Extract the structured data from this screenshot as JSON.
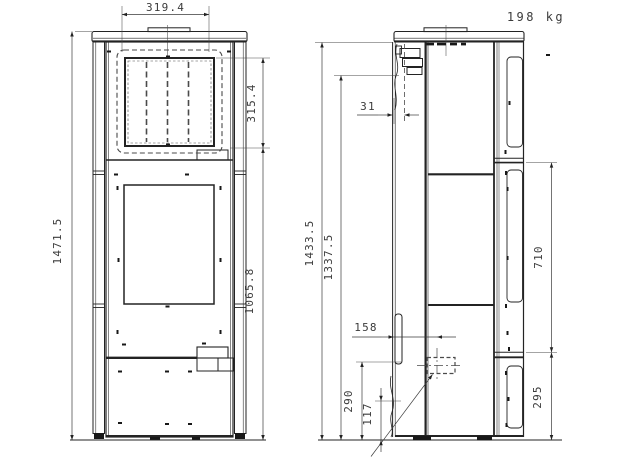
{
  "drawing": {
    "weight": "198 kg",
    "front_view": {
      "top_width": "319.4",
      "glass_height": "315.4",
      "overall_height": "1471.5",
      "lower_section_height": "1065.8"
    },
    "side_view": {
      "body_height": "1433.5",
      "flue_connector_height": "1337.5",
      "flue_center_offset": "31",
      "air_connector_offset": "158",
      "air_connector_height": "290",
      "inlet_height": "117",
      "side_panel_upper_height": "710",
      "side_panel_lower_height": "295"
    }
  }
}
